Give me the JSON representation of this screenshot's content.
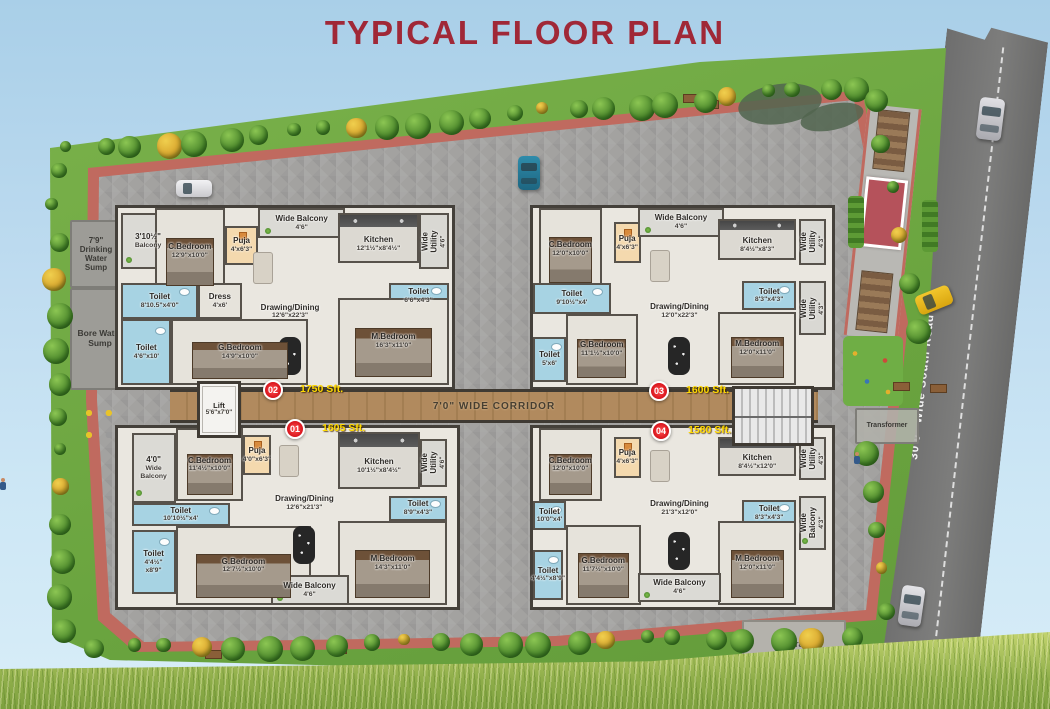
{
  "title": "TYPICAL FLOOR PLAN",
  "road": {
    "label": "30'0\" Wide South Road"
  },
  "corridor": {
    "label": "7'0\" WIDE CORRIDOR"
  },
  "lift": {
    "name": "Lift",
    "dims": "5'6\"x7'0\""
  },
  "generator": {
    "label": "Generator"
  },
  "transformer": {
    "label": "Transformer"
  },
  "sumps": {
    "drinking": "7'9\"\nDrinking\nWater\nSump",
    "bore": "Bore Water\nSump"
  },
  "colors": {
    "title_red": "#a02837",
    "badge_red": "#d8141c",
    "area_yellow": "#ffd900",
    "corridor_wood": "#ab8458",
    "toilet_blue": "#a7d3e3",
    "puja_peach": "#f4d9ae",
    "road_grey": "#757575",
    "lawn_green": "#6aa43f"
  },
  "floorplan": {
    "units": [
      {
        "id": "01",
        "area": "1605 Sft.",
        "badge": {
          "x": 295,
          "y": 429
        },
        "area_pos": {
          "x": 322,
          "y": 429
        },
        "box": {
          "x": 115,
          "y": 425,
          "w": 345,
          "h": 185
        },
        "rooms": [
          {
            "n": "4'0\"",
            "d": "Wide Balcony",
            "t": "balcony",
            "x": 4,
            "y": 3,
            "w": 13,
            "h": 39
          },
          {
            "n": "C.Bedroom",
            "d": "11'4½\"x10'0\"",
            "t": "bedroom",
            "x": 17,
            "y": 0,
            "w": 20,
            "h": 41
          },
          {
            "n": "Puja",
            "d": "4'0\"x6'3\"",
            "t": "puja",
            "x": 37,
            "y": 4,
            "w": 8,
            "h": 22
          },
          {
            "n": "Kitchen",
            "d": "10'1½\"x8'4½\"",
            "t": "kitchen",
            "x": 65,
            "y": 2,
            "w": 24,
            "h": 32
          },
          {
            "n": "Wide Utility",
            "d": "4'6\"",
            "t": "utility",
            "v": 1,
            "x": 89,
            "y": 6,
            "w": 8,
            "h": 27
          },
          {
            "n": "Toilet",
            "d": "10'10½\"x4'",
            "t": "toilet",
            "x": 4,
            "y": 42,
            "w": 29,
            "h": 13
          },
          {
            "n": "Toilet",
            "d": "4'4½\"\nx8'9\"",
            "t": "toilet",
            "x": 4,
            "y": 57,
            "w": 13,
            "h": 36
          },
          {
            "n": "G.Bedroom",
            "d": "12'7½\"x10'0\"",
            "t": "bedroom",
            "x": 17,
            "y": 55,
            "w": 40,
            "h": 44
          },
          {
            "n": "Drawing/Dining",
            "d": "12'6\"x21'3\"",
            "t": "living",
            "x": 45,
            "y": 2,
            "w": 20,
            "h": 80
          },
          {
            "n": "Toilet",
            "d": "8'9\"x4'3\"",
            "t": "toilet",
            "x": 80,
            "y": 38,
            "w": 17,
            "h": 14
          },
          {
            "n": "M.Bedroom",
            "d": "14'3\"x11'0\"",
            "t": "bedroom",
            "x": 65,
            "y": 52,
            "w": 32,
            "h": 47
          },
          {
            "n": "Wide Balcony",
            "d": "4'6\"",
            "t": "balcony",
            "x": 45,
            "y": 82,
            "w": 23,
            "h": 17
          }
        ]
      },
      {
        "id": "02",
        "area": "1750 Sft.",
        "badge": {
          "x": 273,
          "y": 390
        },
        "area_pos": {
          "x": 300,
          "y": 390
        },
        "box": {
          "x": 115,
          "y": 205,
          "w": 340,
          "h": 185
        },
        "rooms": [
          {
            "n": "3'10½\"",
            "d": "Balcony",
            "t": "balcony",
            "x": 1,
            "y": 3,
            "w": 16,
            "h": 31
          },
          {
            "n": "C.Bedroom",
            "d": "12'9\"x10'0\"",
            "t": "bedroom",
            "x": 11,
            "y": 0,
            "w": 21,
            "h": 48
          },
          {
            "n": "Puja",
            "d": "4'x6'3\"",
            "t": "puja",
            "x": 32,
            "y": 10,
            "w": 10,
            "h": 22
          },
          {
            "n": "Wide Balcony",
            "d": "4'6\"",
            "t": "balcony",
            "x": 42,
            "y": 0,
            "w": 26,
            "h": 17
          },
          {
            "n": "Kitchen",
            "d": "12'1½\"x8'4½\"",
            "t": "kitchen",
            "x": 66,
            "y": 3,
            "w": 24,
            "h": 28
          },
          {
            "n": "Wide Utility",
            "d": "4'6\"",
            "t": "utility",
            "v": 1,
            "x": 90,
            "y": 3,
            "w": 9,
            "h": 31
          },
          {
            "n": "Toilet",
            "d": "8'10.5\"x4'0\"",
            "t": "toilet",
            "x": 1,
            "y": 42,
            "w": 23,
            "h": 20
          },
          {
            "n": "Dress",
            "d": "4'x6'",
            "t": "dress",
            "x": 24,
            "y": 42,
            "w": 13,
            "h": 20
          },
          {
            "n": "Toilet",
            "d": "4'6\"x10'",
            "t": "toilet",
            "x": 1,
            "y": 62,
            "w": 15,
            "h": 37
          },
          {
            "n": "G.Bedroom",
            "d": "14'9\"x10'0\"",
            "t": "bedroom",
            "x": 16,
            "y": 62,
            "w": 41,
            "h": 37
          },
          {
            "n": "Drawing/Dining",
            "d": "12'6\"x22'3\"",
            "t": "living",
            "x": 37,
            "y": 17,
            "w": 29,
            "h": 82
          },
          {
            "n": "Toilet",
            "d": "6'6\"x4'3\"",
            "t": "toilet",
            "x": 81,
            "y": 42,
            "w": 18,
            "h": 15
          },
          {
            "n": "M.Bedroom",
            "d": "16'3\"x11'0\"",
            "t": "bedroom",
            "x": 66,
            "y": 50,
            "w": 33,
            "h": 49
          }
        ]
      },
      {
        "id": "03",
        "area": "1600 Sft.",
        "badge": {
          "x": 659,
          "y": 391
        },
        "area_pos": {
          "x": 686,
          "y": 391
        },
        "box": {
          "x": 530,
          "y": 205,
          "w": 305,
          "h": 185
        },
        "rooms": [
          {
            "n": "C.Bedroom",
            "d": "12'0\"x10'0\"",
            "t": "bedroom",
            "x": 2,
            "y": 0,
            "w": 21,
            "h": 46
          },
          {
            "n": "Puja",
            "d": "4'x6'3\"",
            "t": "puja",
            "x": 27,
            "y": 8,
            "w": 9,
            "h": 23
          },
          {
            "n": "Wide Balcony",
            "d": "4'6\"",
            "t": "balcony",
            "x": 35,
            "y": 0,
            "w": 29,
            "h": 16
          },
          {
            "n": "Kitchen",
            "d": "8'4½\"x8'3\"",
            "t": "kitchen",
            "x": 62,
            "y": 6,
            "w": 26,
            "h": 23
          },
          {
            "n": "Wide Utility",
            "d": "4'3\"",
            "t": "utility",
            "v": 1,
            "x": 89,
            "y": 6,
            "w": 9,
            "h": 26
          },
          {
            "n": "Toilet",
            "d": "9'10½\"x4'",
            "t": "toilet",
            "x": 0,
            "y": 42,
            "w": 26,
            "h": 17
          },
          {
            "n": "Toilet",
            "d": "5'x6'",
            "t": "toilet",
            "x": 0,
            "y": 72,
            "w": 11,
            "h": 25
          },
          {
            "n": "G.Bedroom",
            "d": "11'1½\"x10'0\"",
            "t": "bedroom",
            "x": 11,
            "y": 59,
            "w": 24,
            "h": 40
          },
          {
            "n": "Drawing/Dining",
            "d": "12'0\"x22'3\"",
            "t": "living",
            "x": 36,
            "y": 16,
            "w": 26,
            "h": 83
          },
          {
            "n": "Toilet",
            "d": "8'3\"x4'3\"",
            "t": "toilet",
            "x": 70,
            "y": 41,
            "w": 18,
            "h": 16
          },
          {
            "n": "Wide Utility",
            "d": "4'3\"",
            "t": "utility",
            "v": 1,
            "x": 89,
            "y": 41,
            "w": 9,
            "h": 30
          },
          {
            "n": "M.Bedroom",
            "d": "12'0\"x11'0\"",
            "t": "bedroom",
            "x": 62,
            "y": 58,
            "w": 26,
            "h": 41
          }
        ]
      },
      {
        "id": "04",
        "area": "1580 Sft.",
        "badge": {
          "x": 661,
          "y": 431
        },
        "area_pos": {
          "x": 688,
          "y": 431
        },
        "box": {
          "x": 530,
          "y": 425,
          "w": 305,
          "h": 185
        },
        "rooms": [
          {
            "n": "C.Bedroom",
            "d": "12'0\"x10'0\"",
            "t": "bedroom",
            "x": 2,
            "y": 0,
            "w": 21,
            "h": 41
          },
          {
            "n": "Puja",
            "d": "4'x6'3\"",
            "t": "puja",
            "x": 27,
            "y": 5,
            "w": 9,
            "h": 23
          },
          {
            "n": "Kitchen",
            "d": "8'4½\"x12'0\"",
            "t": "kitchen",
            "x": 62,
            "y": 5,
            "w": 26,
            "h": 22
          },
          {
            "n": "Wide Utility",
            "d": "4'3\"",
            "t": "utility",
            "v": 1,
            "x": 89,
            "y": 5,
            "w": 9,
            "h": 24
          },
          {
            "n": "Toilet",
            "d": "10'0\"x4'",
            "t": "toilet",
            "x": 0,
            "y": 41,
            "w": 11,
            "h": 16
          },
          {
            "n": "Toilet",
            "d": "4'4½\"x8'9\"",
            "t": "toilet",
            "x": 0,
            "y": 68,
            "w": 10,
            "h": 28
          },
          {
            "n": "G.Bedroom",
            "d": "11'7½\"x10'0\"",
            "t": "bedroom",
            "x": 11,
            "y": 54,
            "w": 25,
            "h": 45
          },
          {
            "n": "Drawing/Dining",
            "d": "21'3\"x12'0\"",
            "t": "living",
            "x": 36,
            "y": 5,
            "w": 26,
            "h": 80
          },
          {
            "n": "Toilet",
            "d": "8'3\"x4'3\"",
            "t": "toilet",
            "x": 70,
            "y": 40,
            "w": 18,
            "h": 15
          },
          {
            "n": "M.Bedroom",
            "d": "12'0\"x11'0\"",
            "t": "bedroom",
            "x": 62,
            "y": 52,
            "w": 26,
            "h": 47
          },
          {
            "n": "Wide Balcony",
            "d": "4'3\"",
            "t": "balcony",
            "v": 1,
            "x": 89,
            "y": 38,
            "w": 9,
            "h": 30
          },
          {
            "n": "Wide Balcony",
            "d": "4'6\"",
            "t": "balcony",
            "x": 35,
            "y": 81,
            "w": 28,
            "h": 16
          }
        ]
      }
    ]
  }
}
